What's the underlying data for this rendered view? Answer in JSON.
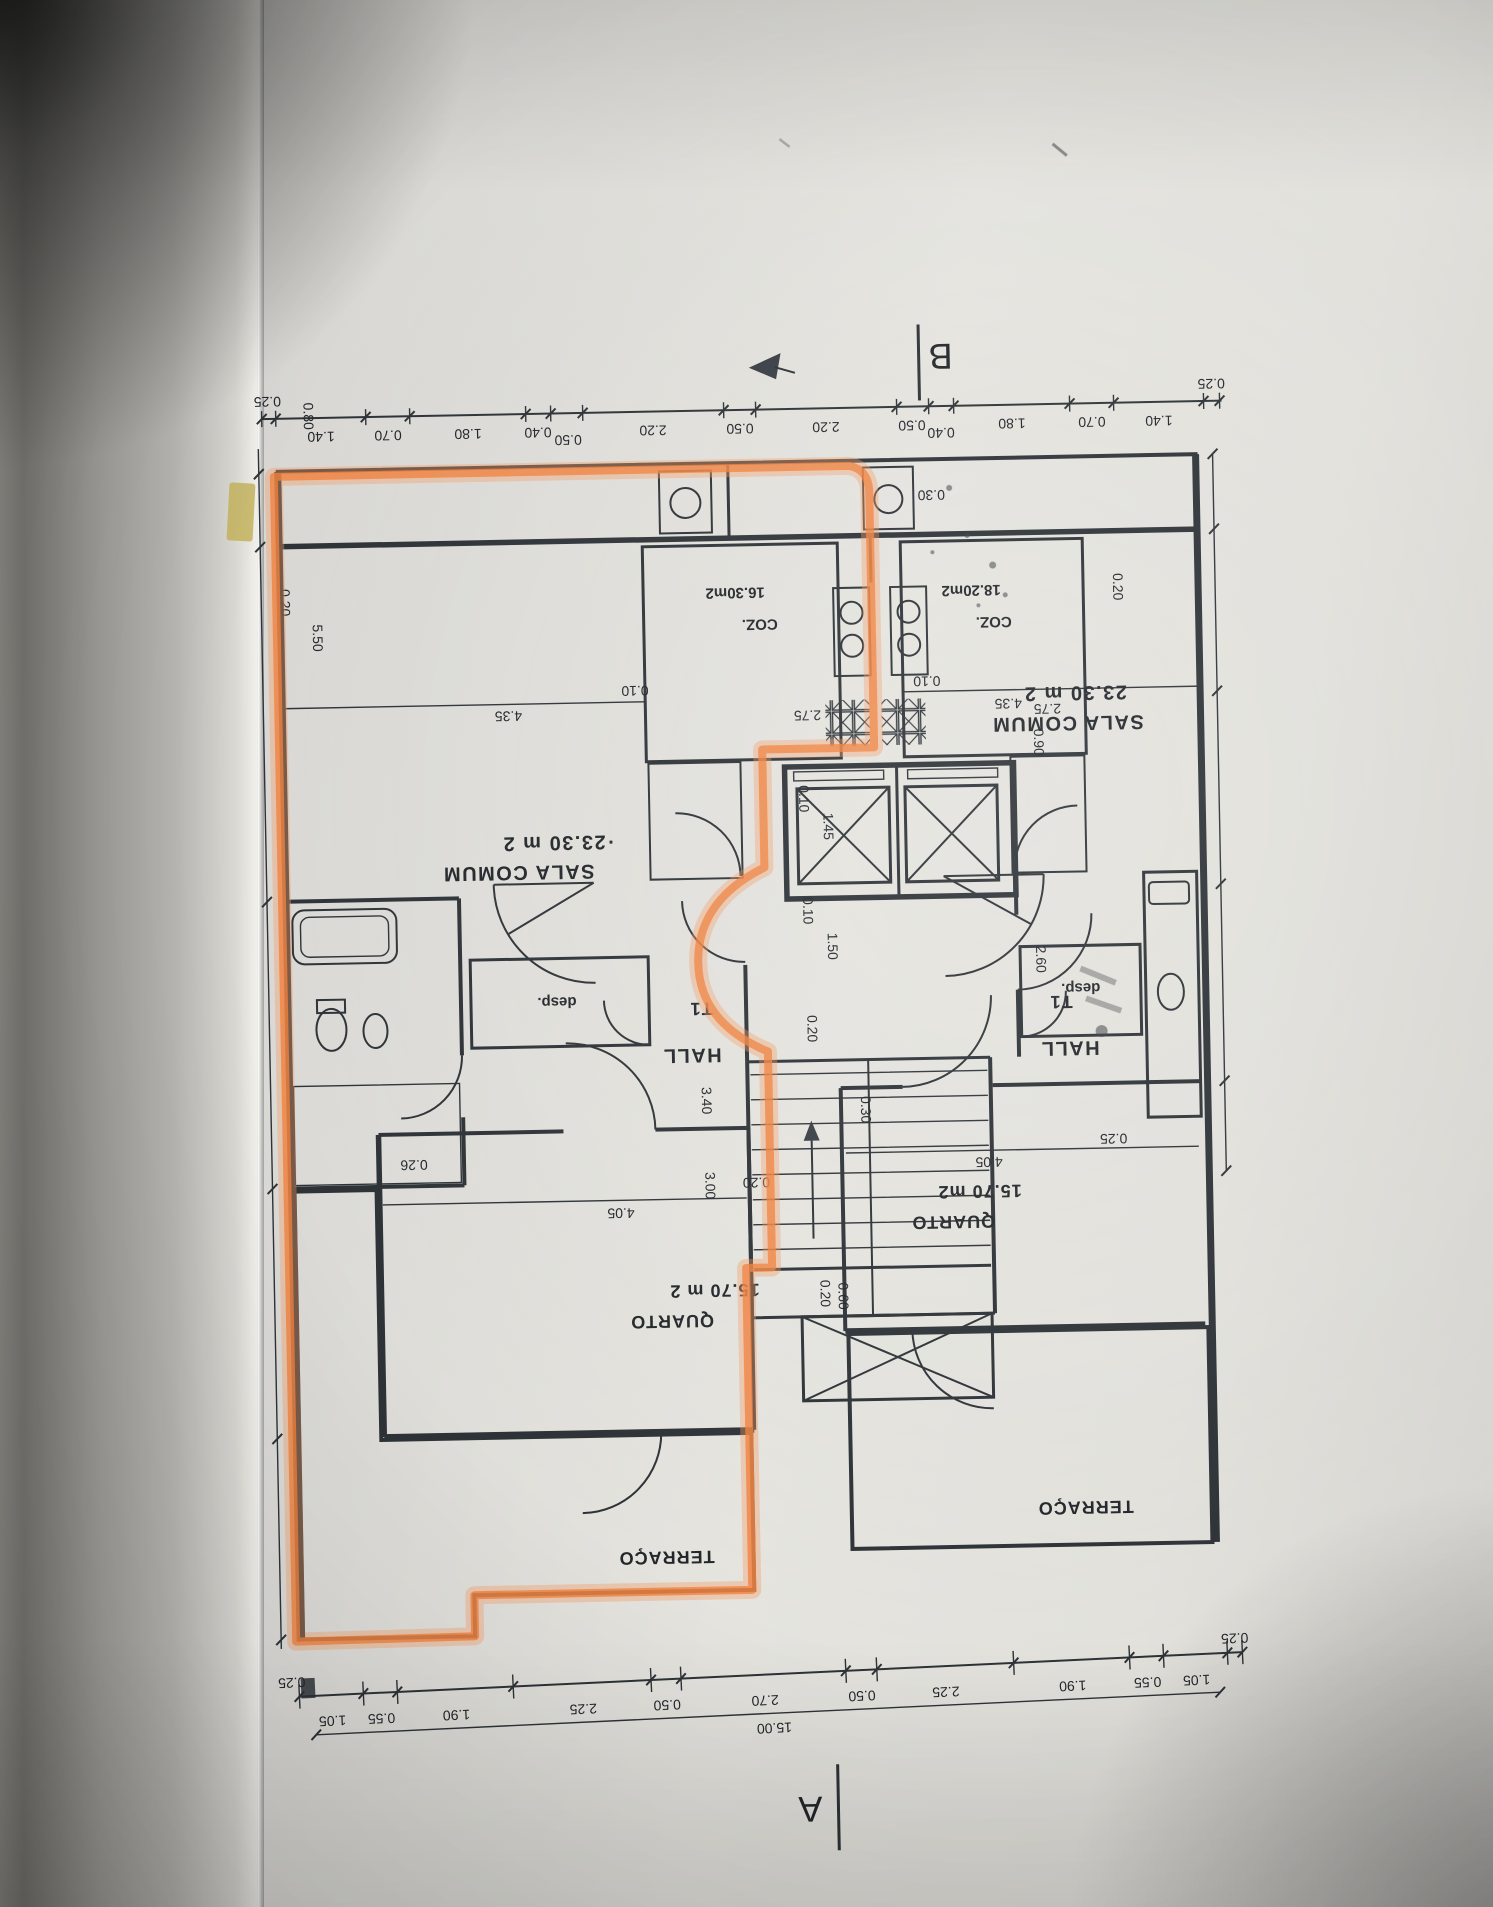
{
  "markers": {
    "section_a": "A",
    "section_b": "B"
  },
  "units": {
    "left": {
      "type": "T1",
      "hall": "HALL",
      "pantry": "desp.",
      "living_name": "SALA COMUM",
      "living_area": "·23.30 m 2",
      "kitchen_name": "COZ.",
      "kitchen_area": "16.30m2",
      "bedroom_name": "QUARTO",
      "bedroom_area": "15.70 m 2",
      "terrace": "TERRAÇO"
    },
    "right": {
      "type": "T1",
      "hall": "HALL",
      "pantry": "desp.",
      "living_name": "SALA COMUM",
      "living_area": "23.30 m 2",
      "kitchen_name": "COZ.",
      "kitchen_area": "18.20m2",
      "bedroom_name": "QUARTO",
      "bedroom_area": "15.70 m2",
      "terrace": "TERRAÇO"
    }
  },
  "rulers": {
    "top": [
      "0.25",
      "1.40",
      "0.70",
      "1.80",
      "0.40",
      "0.50",
      "2.20",
      "0.50",
      "2.20",
      "0.50",
      "0.40",
      "1.80",
      "0.70",
      "1.40",
      "0.25"
    ],
    "bottom": [
      "0.25",
      "1.05",
      "0.55",
      "1.90",
      "2.25",
      "0.50",
      "2.70",
      "0.50",
      "2.25",
      "1.90",
      "0.55",
      "1.05",
      "0.25"
    ],
    "total": "15.00"
  },
  "dims": {
    "d080": "0.80",
    "d020_left": "0.20",
    "d550": "5.50",
    "d010_left": "0.10",
    "d435_left": "4.35",
    "d010_right": "0.10",
    "d435_right": "4.35",
    "d020_right": "0.20",
    "d275_left": "2.75",
    "d275_right": "2.75",
    "d090": "0.90",
    "d030_top": "0.30",
    "d010_core_top": "0.10",
    "d145": "1.45",
    "d010_core_bot": "0.10",
    "d150": "1.50",
    "d020_landing": "0.20",
    "d260": "2.60",
    "d340": "3.40",
    "d300": "3.00",
    "d020_stairs": "0.20",
    "d020_stairs2": "0.20",
    "d060": "0.60",
    "d405_left": "4.05",
    "d026": "0.26",
    "d405_right": "4.05",
    "d025_right": "0.25",
    "d030_right": "0.30"
  }
}
